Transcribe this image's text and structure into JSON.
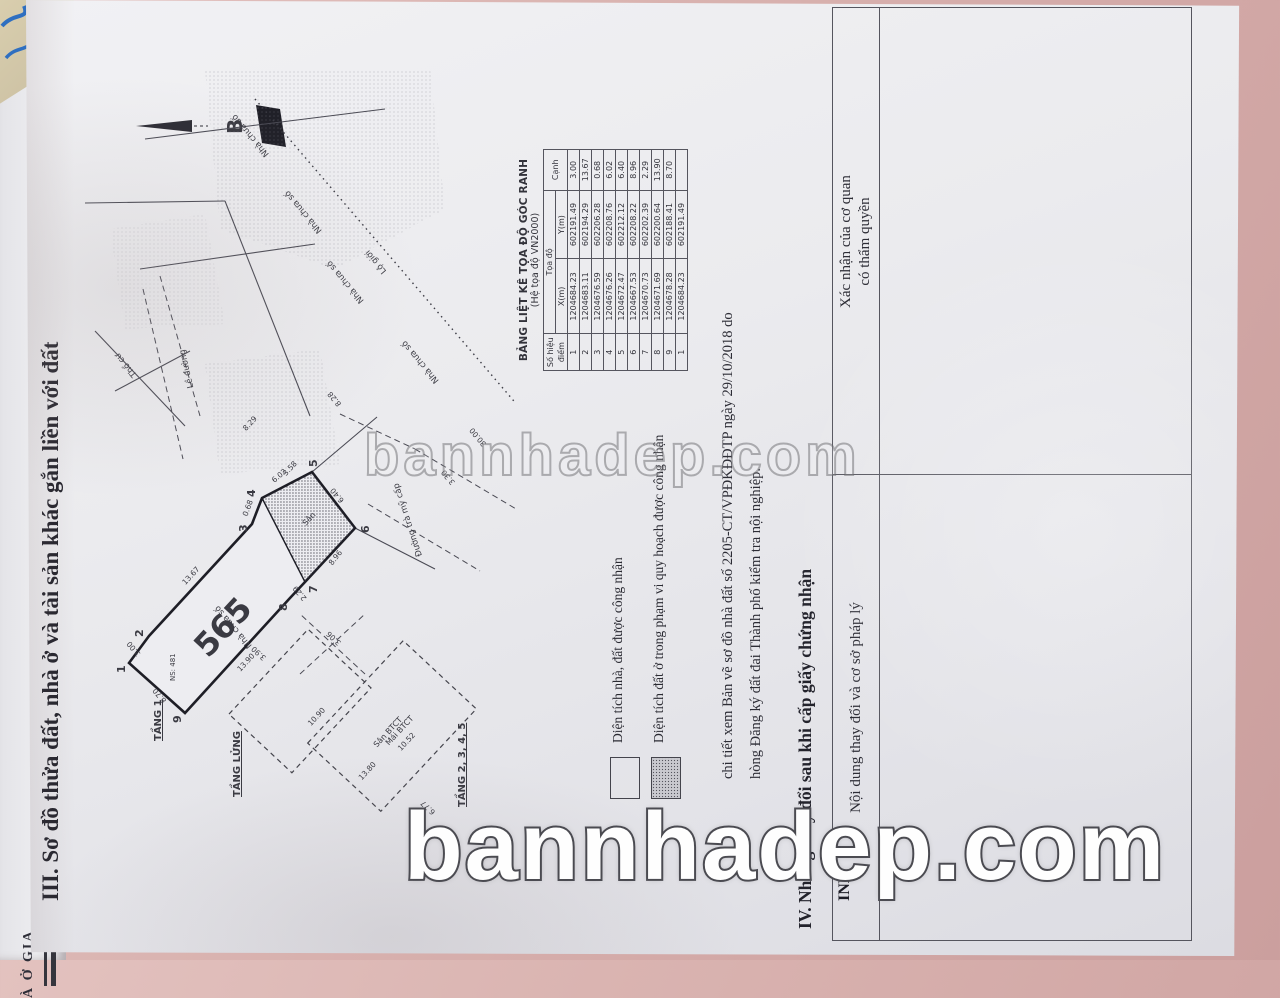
{
  "page": {
    "heading_iii": "III. Sơ đồ thửa đất, nhà ở và tài sản khác gắn liền với đất",
    "heading_iv": "IV. Những thay đổi sau khi cấp giấy chứng nhận",
    "paragraph_line1": "chi tiết xem Bản vẽ sơ đồ nhà đất số 2205-CT/VPĐKĐĐTP ngày 29/10/2018 do",
    "paragraph_line2": "hòng Đăng ký đất đai Thành phố kiểm tra nội nghiệp.",
    "edge_fragment_left": "À Ở GIA",
    "edge_fragment_inh": "INH"
  },
  "legend": {
    "item1": "Diện tích nhà, đất được công nhận",
    "item2": "Diện tích đất ở trong phạm vi quy hoạch được công nhận"
  },
  "iv_table": {
    "col_left": "Nội dung thay đổi và cơ sở pháp lý",
    "col_right_line1": "Xác nhận của cơ quan",
    "col_right_line2": "có thẩm quyền"
  },
  "coord_table": {
    "title": "BẢNG LIỆT KÊ TỌA ĐỘ GÓC RANH",
    "subtitle": "(Hệ tọa độ VN2000)",
    "col_point": "Số hiệu điểm",
    "col_coord": "Tọa độ",
    "col_x": "X(m)",
    "col_y": "Y(m)",
    "col_edge": "Cạnh",
    "rows": [
      {
        "p": "1",
        "x": "1204684.23",
        "y": "602191.49",
        "c": "3.00"
      },
      {
        "p": "2",
        "x": "1204683.11",
        "y": "602194.29",
        "c": "13.67"
      },
      {
        "p": "3",
        "x": "1204676.59",
        "y": "602206.28",
        "c": "0.68"
      },
      {
        "p": "4",
        "x": "1204676.26",
        "y": "602208.76",
        "c": "6.02"
      },
      {
        "p": "5",
        "x": "1204672.47",
        "y": "602212.12",
        "c": "6.40"
      },
      {
        "p": "6",
        "x": "1204667.53",
        "y": "602208.22",
        "c": "8.96"
      },
      {
        "p": "7",
        "x": "1204670.73",
        "y": "602202.39",
        "c": "2.29"
      },
      {
        "p": "8",
        "x": "1204671.69",
        "y": "602200.64",
        "c": "13.90"
      },
      {
        "p": "9",
        "x": "1204678.28",
        "y": "602188.41",
        "c": "8.70"
      },
      {
        "p": "1",
        "x": "1204684.23",
        "y": "602191.49",
        "c": ""
      }
    ]
  },
  "drawing": {
    "parcel_number": "565",
    "san": "Sân",
    "tang1": "TẦNG 1",
    "tang_lung": "TẦNG LỬNG",
    "tang2345": "TẦNG 2, 3, 4, 5",
    "san_btct": "Sân BTCT",
    "mai_btct": "Mái BTCT",
    "ns481": "NS: 481",
    "tho_cu": "Thổ cư",
    "nha_chua_so": "Nhà chưa số",
    "le_duong": "Lề đường",
    "lo_gioi": "Lộ giới",
    "alley": "Đường trà mỹ cấp",
    "north_letter": "B",
    "points": [
      "1",
      "2",
      "3",
      "4",
      "5",
      "6",
      "7",
      "8",
      "9"
    ],
    "edge_dims": [
      "3.00",
      "13.67",
      "0.68",
      "6.02",
      "6.40",
      "8.96",
      "2.29",
      "13.90",
      "8.70"
    ],
    "extra_dims": [
      "10.90",
      "10.52",
      "3.90",
      "3.06",
      "13.80",
      "6.77",
      "8.28",
      "8.29",
      "3.30",
      "30.00",
      "3.58"
    ]
  },
  "watermark": {
    "mid": "bannhadep.com",
    "big": "bannhadep.com"
  }
}
